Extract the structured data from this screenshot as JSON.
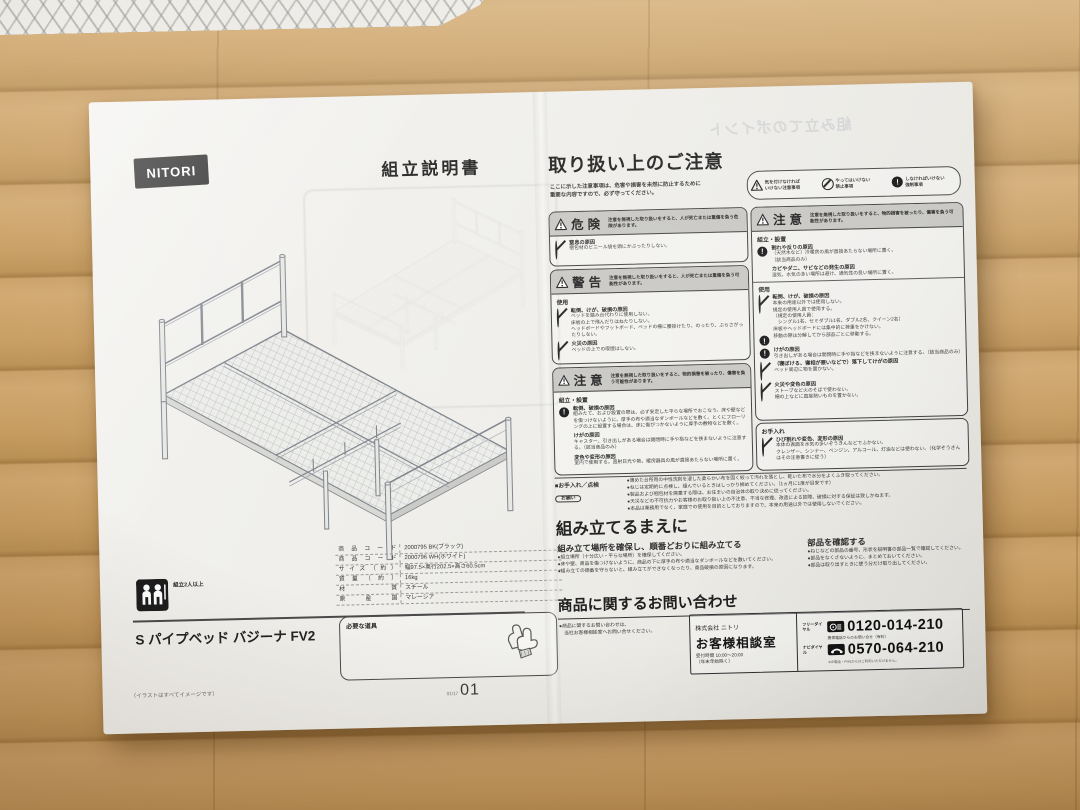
{
  "left": {
    "logo": "NITORI",
    "title": "組立説明書",
    "people_note": "組立2人以上",
    "product_name": "S パイプベッド バジーナ FV2",
    "spec": [
      {
        "label": "商品コード",
        "value": "2000795 BK(ブラック)"
      },
      {
        "label": "商品コード",
        "value": "2000796 WH(ホワイト)"
      },
      {
        "label": "サイズ（約）",
        "value": "幅97.5×奥行202.5×高さ60.5cm"
      },
      {
        "label": "質量（約）",
        "value": "16kg"
      },
      {
        "label": "材質",
        "value": "スチール"
      },
      {
        "label": "原産国",
        "value": "マレーシア"
      }
    ],
    "tools_title": "必要な道具",
    "image_note": "（イラストはすべてイメージです）",
    "page_code": "01/17",
    "page_number": "01"
  },
  "right": {
    "ghost_title": "組み立てのポイント",
    "header": "取り扱い上のご注意",
    "intro1": "ここに示した注意事項は、危害や損害を未然に防止するために",
    "intro2": "重要な内容ですので、必ず守ってください。",
    "legend": [
      {
        "line1": "気を付けなければ",
        "line2": "いけない注意事項"
      },
      {
        "line1": "やってはいけない",
        "line2": "禁止事項"
      },
      {
        "line1": "しなければいけない",
        "line2": "強制事項"
      }
    ],
    "danger": {
      "title": "危険",
      "desc": "注意を無視した取り扱いをすると、人が死亡または重傷を負う危険があります。",
      "h0": "窒息の原因",
      "l0": "梱包材のビニール袋を頭にかぶったりしない。"
    },
    "warning": {
      "title": "警告",
      "desc": "注意を無視した取り扱いをすると、人が死亡または重傷を負う可能性があります。",
      "section": "使用",
      "i0h": "転倒、けが、破損の原因",
      "i0l0": "ベッドを踏み台代わりに使用しない。",
      "i0l1": "床板の上で飛んだりはねたりしない。",
      "i0l2": "ヘッドボードやフットボード、ベッドの柵に腰掛けたり、のったり、ぶらさがったりしない。",
      "i1h": "火災の原因",
      "i1l0": "ベッドの上での喫煙はしない。"
    },
    "caution_l": {
      "title": "注意",
      "desc": "注意を無視した取り扱いをすると、物的損害を被ったり、傷害を負う可能性があります。",
      "section": "組立・設置",
      "i0h": "転倒、破損の原因",
      "i0l0": "組みたて、および設置の際は、必ず安定した平らな場所でおこなう。床や壁などを傷つけないように、厚手の布や適当なダンボールなどを敷く。とくにフローリングの上に設置する場合は、床に傷がつかないように厚手の敷物などを敷く。",
      "i1h": "けがの原因",
      "i1l0": "キャスター、引き出しがある場合は開閉時に手や指などを挟まないように注意する。（該当商品のみ）",
      "i2h": "変色や変形の原因",
      "i2l0": "室内で使用する。直射日光や熱、暖房器具の風が直接あたらない場所に置く。"
    },
    "caution_r": {
      "title": "注意",
      "desc": "注意を無視した取り扱いをすると、物的損害を被ったり、傷害を負う可能性があります。",
      "section1": "組立・設置",
      "a_h": "割れや反りの原因",
      "a_l0": "（天然木など）冷暖房の風が直接あたらない場所に置く。",
      "a_l1": "（該当商品のみ）",
      "b_h": "カビやダニ、サビなどの発生の原因",
      "b_l0": "湿気、水気の多い場所は避け、通気性の良い場所に置く。",
      "section2": "使用",
      "c_h": "転倒、けが、破損の原因",
      "c_l0": "本来の用途以外では使用しない。",
      "c_l1": "規定の使用人員で使用する。",
      "c_l2": "（規定の使用人員：",
      "c_l3": "　シングル1名、セミダブル1名、ダブル2名、クイーン2名）",
      "c_l4": "床板やヘッドボードには集中的に荷重をかけない。",
      "d_l0": "移動の際は分解してから部品ごとに移動する。",
      "e_h": "けがの原因",
      "e_l0": "引き出しがある場合は開閉時に手や指などを挟まないように注意する。（該当商品のみ）",
      "f_h": "（寝ぼける、寝相が悪いなどで）落下してけがの原因",
      "f_l0": "ベッド周辺に物を置かない。",
      "g_h": "火災や変色の原因",
      "g_l0": "ストーブなど火のそばで使わない。",
      "g_l1": "柵の上などに直接熱いものを置かない。"
    },
    "care": {
      "section": "お手入れ",
      "h": "ひび割れや変色、変形の原因",
      "l0": "本体の表面を水気の多いぞうきんなどでふかない。",
      "l1": "クレンザー、シンナー、ベンジン、アルコール、灯油などは使わない。（化学ぞうきんはその注意書きに従う）"
    },
    "maint": {
      "label": "■お手入れ／点検",
      "b0": "●薄めた台所用の中性洗剤を浸した柔らかい布を固く絞って汚れを落とし、乾いた布で水分をよくふき取ってください。",
      "b1": "●ねじは定期的に点検し、緩んでいるときはしっかり締めてください。（1ヵ月に1度が目安です）",
      "req": "お願い",
      "r0": "●製品および梱包材を廃棄する際は、お住まいの自治体の取り決めに従ってください。",
      "r1": "●天災などの不可抗力やお客様のお取り扱い上の不注意、不当な修理、改造による故障、破損に対する保証は致しかねます。",
      "r2": "●本品は業務用でなく、家庭での使用を目的としておりますので、本来の用途以外では使用しないでください。"
    },
    "before": {
      "header": "組み立てるまえに",
      "s1": "組み立て場所を確保し、順番どおりに組み立てる",
      "s1b0": "●組立場所（十分広い・平らな場所）を確保してください。",
      "s1b1": "●床や壁、商品を傷つけないように、商品の下に厚手の布や適当なダンボールなどを敷いてください。",
      "s1b2": "●組み立ての順番を守らないと、組み立てができなくなったり、商品破損の原因になります。",
      "s2": "部品を確認する",
      "s2b0": "●ねじなどの部品の番号、形状を説明書の部品一覧で確認してください。",
      "s2b1": "●部品をなくさないように、まとめておいてください。",
      "s2b2": "●部品は取り出すときに使う分だけ取り出してください。"
    },
    "inquiry": {
      "header": "商品に関するお問い合わせ",
      "note0": "●商品に関するお問い合わせは、",
      "note1": "　当社お客様相談室へお問い合せください。",
      "company": "株式会社 ニトリ",
      "office": "お客様相談室",
      "hours": "受付時間 10:00～20:00",
      "hours_note": "（年末年始除く）",
      "free_label": "フリーダイヤル",
      "free_number": "0120-014-210",
      "mobile_note": "携帯電話からのお問い合せ（有料）",
      "navi_label": "ナビダイヤル",
      "navi_number": "0570-064-210",
      "navi_note": "※IP電話・PHSからはご利用いただけません。",
      "exclaim": "!"
    }
  }
}
